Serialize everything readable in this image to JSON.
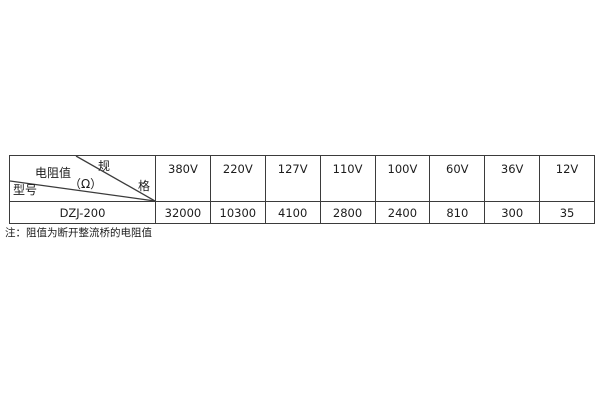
{
  "table": {
    "corner": {
      "spec_char_top": "规",
      "spec_char_bottom": "格",
      "value_label": "电阻值",
      "value_unit": "（Ω）",
      "model_label": "型号"
    },
    "voltage_headers": [
      "380V",
      "220V",
      "127V",
      "110V",
      "100V",
      "60V",
      "36V",
      "12V"
    ],
    "rows": [
      {
        "model": "DZJ-200",
        "values": [
          "32000",
          "10300",
          "4100",
          "2800",
          "2400",
          "810",
          "300",
          "35"
        ]
      }
    ]
  },
  "note": "注：阻值为断开整流桥的电阻值",
  "colors": {
    "border": "#3b3b3b",
    "text": "#1c1c1c",
    "background": "#ffffff"
  }
}
